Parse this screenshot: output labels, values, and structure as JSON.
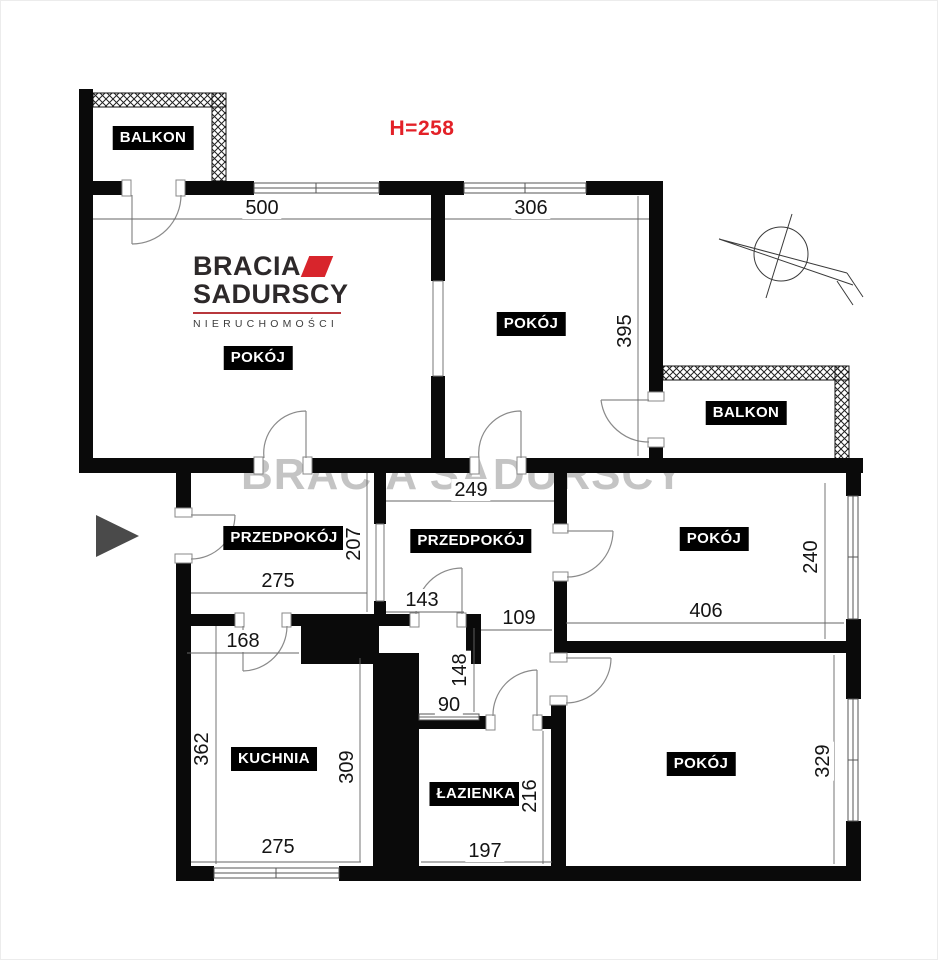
{
  "header": {
    "height_label": "H=258"
  },
  "watermark": "BRACIA SADURSCY",
  "logo": {
    "line1": "BRACIA",
    "line2": "SADURSCY",
    "subtitle": "NIERUCHOMOŚCI"
  },
  "rooms": {
    "balkon_left": "BALKON",
    "balkon_right": "BALKON",
    "pokoj_top_left": "POKÓJ",
    "pokoj_top_right": "POKÓJ",
    "pokoj_mid_right": "POKÓJ",
    "pokoj_bottom_right": "POKÓJ",
    "przedpokoj_left": "PRZEDPOKÓJ",
    "przedpokoj_mid": "PRZEDPOKÓJ",
    "kuchnia": "KUCHNIA",
    "lazienka": "ŁAZIENKA"
  },
  "dims": {
    "d500": "500",
    "d306": "306",
    "d395": "395",
    "d249": "249",
    "d207": "207",
    "d275_hall": "275",
    "d143": "143",
    "d109": "109",
    "d406": "406",
    "d240": "240",
    "d168": "168",
    "d362": "362",
    "d309": "309",
    "d90": "90",
    "d148": "148",
    "d216": "216",
    "d197": "197",
    "d275_kitchen": "275",
    "d329": "329"
  },
  "colors": {
    "wall": "#0a0a0a",
    "accent_red": "#e32128",
    "logo_red": "#d8252c",
    "watermark_gray": "#c4c4c4",
    "entrance_arrow": "#4a4a4a"
  }
}
